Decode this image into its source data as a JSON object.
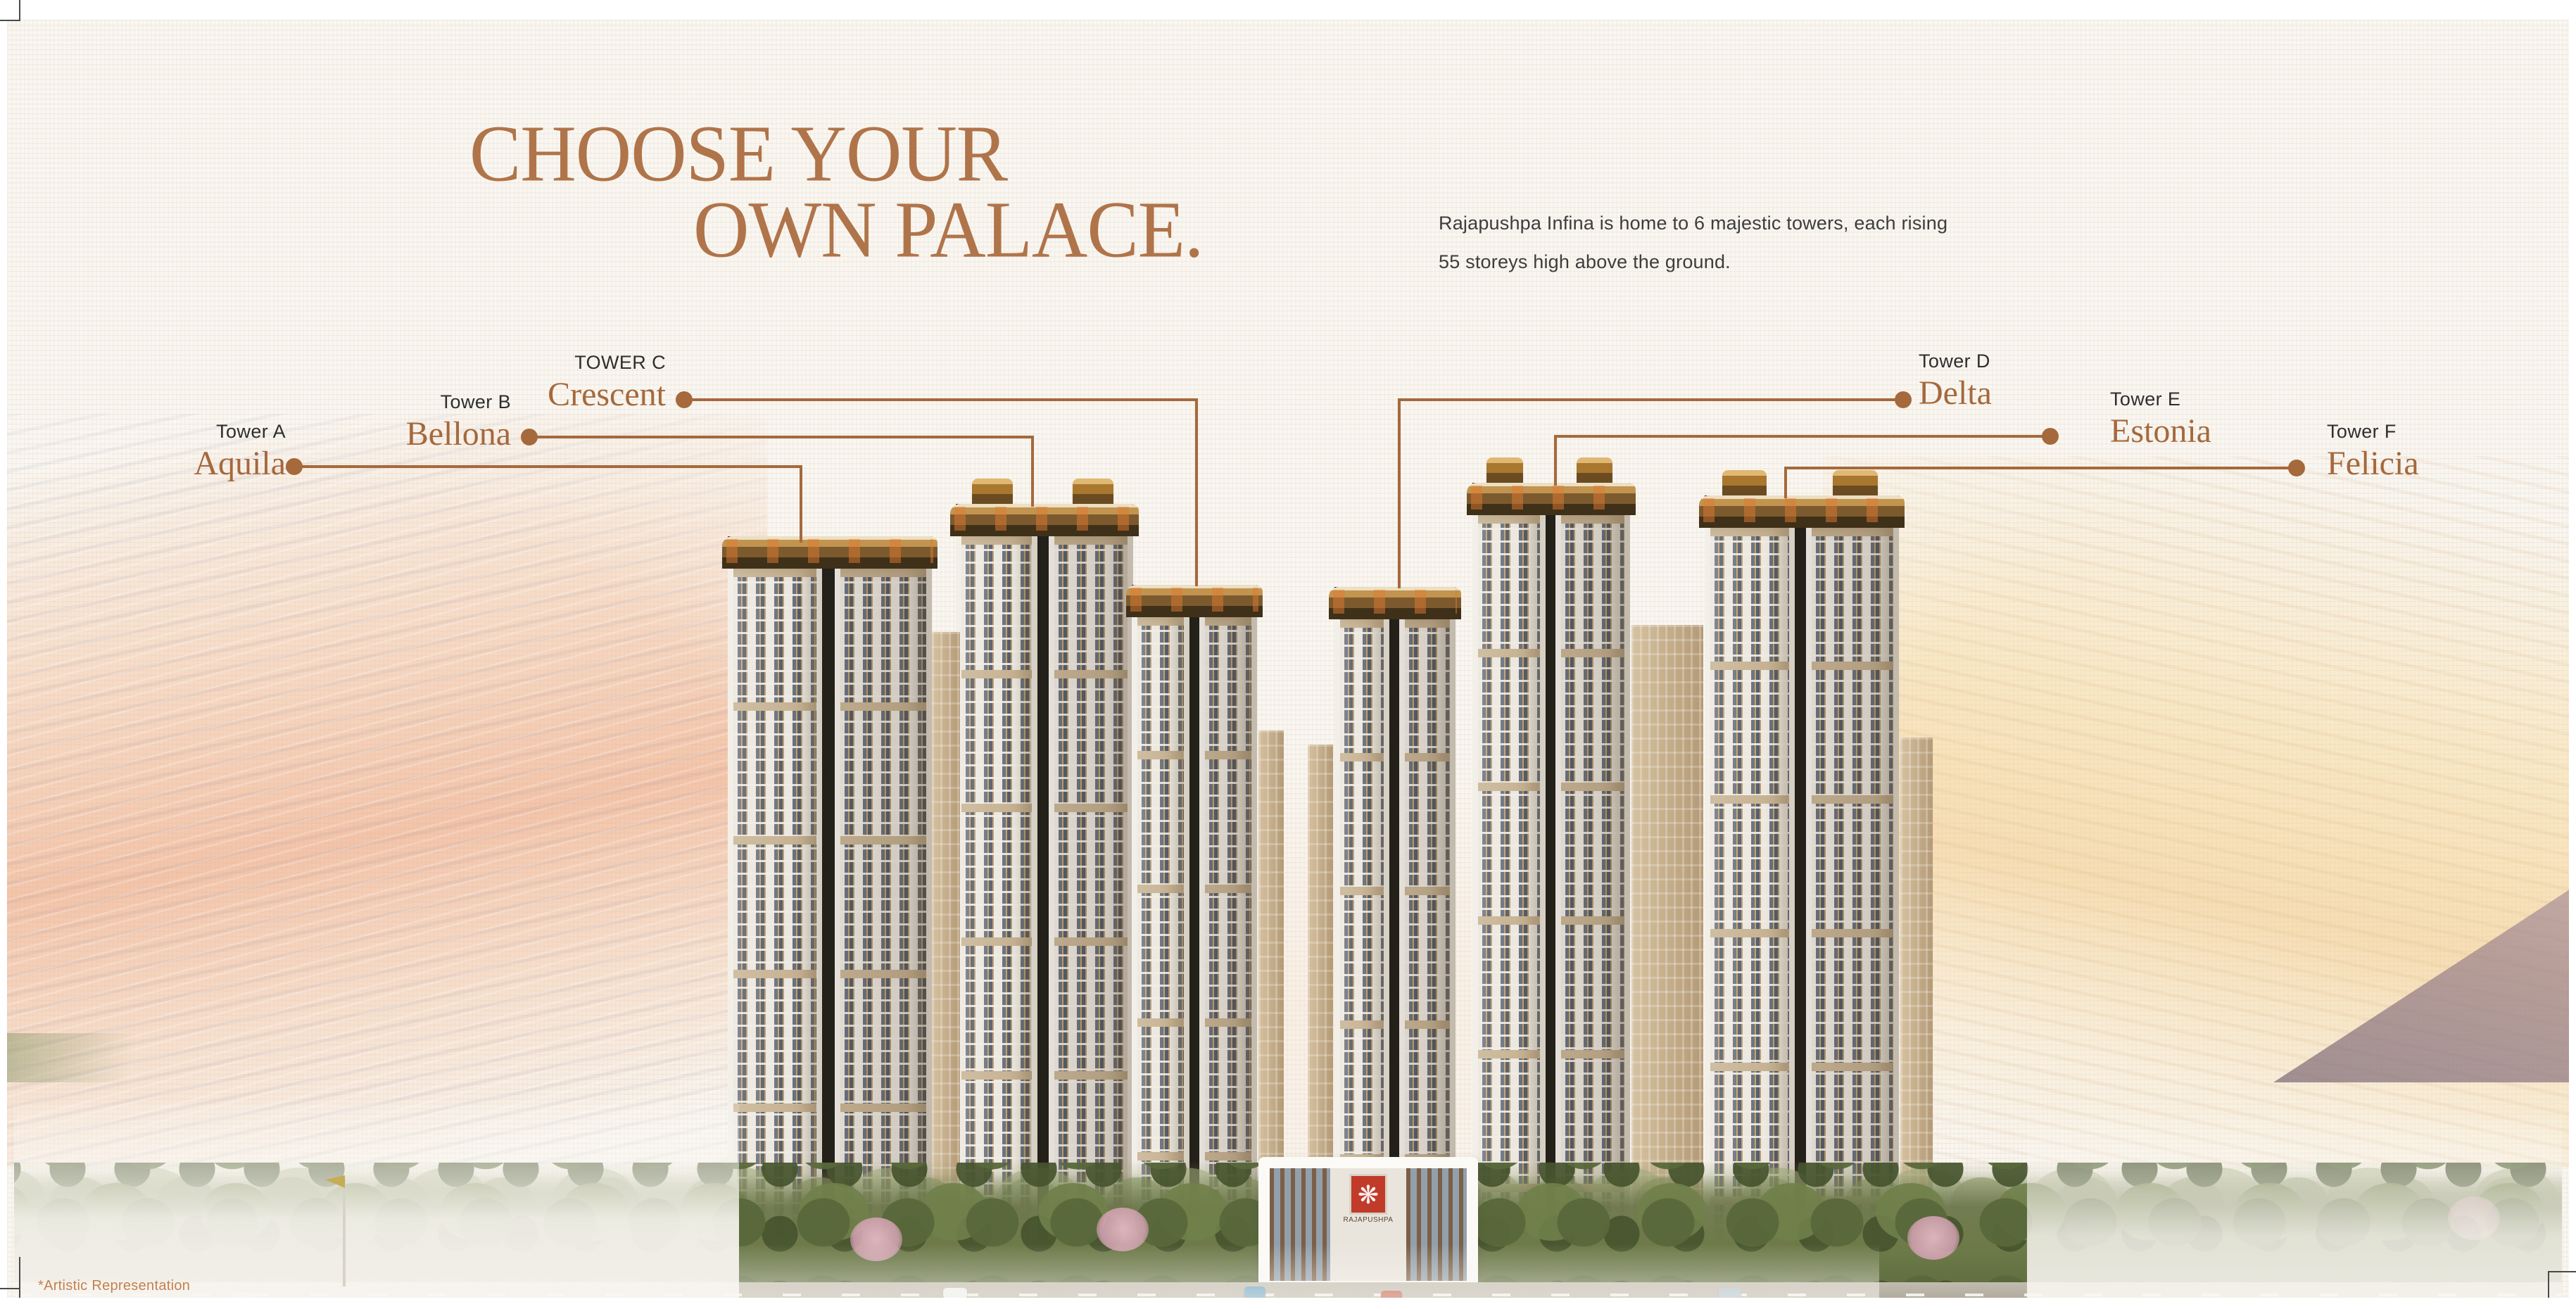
{
  "header": {
    "title_line1": "CHOOSE YOUR",
    "title_line2": "OWN PALACE.",
    "description_line1": "Rajapushpa Infina is home to 6 majestic towers, each rising",
    "description_line2": "55 storeys high above the ground."
  },
  "towers": [
    {
      "id": "a",
      "label": "Tower A",
      "name": "Aquila"
    },
    {
      "id": "b",
      "label": "Tower B",
      "name": "Bellona"
    },
    {
      "id": "c",
      "label": "TOWER C",
      "name": "Crescent"
    },
    {
      "id": "d",
      "label": "Tower D",
      "name": "Delta"
    },
    {
      "id": "e",
      "label": "Tower E",
      "name": "Estonia"
    },
    {
      "id": "f",
      "label": "Tower F",
      "name": "Felicia"
    }
  ],
  "clubhouse": {
    "logo_text": "RAJAPUSHPA"
  },
  "footnote": "*Artistic Representation",
  "colors": {
    "accent_brown": "#a5693c",
    "title_brown": "#b0744a",
    "label_dark": "#2e2e2e",
    "logo_red": "#c13b2a",
    "paper": "#faf7f2"
  }
}
